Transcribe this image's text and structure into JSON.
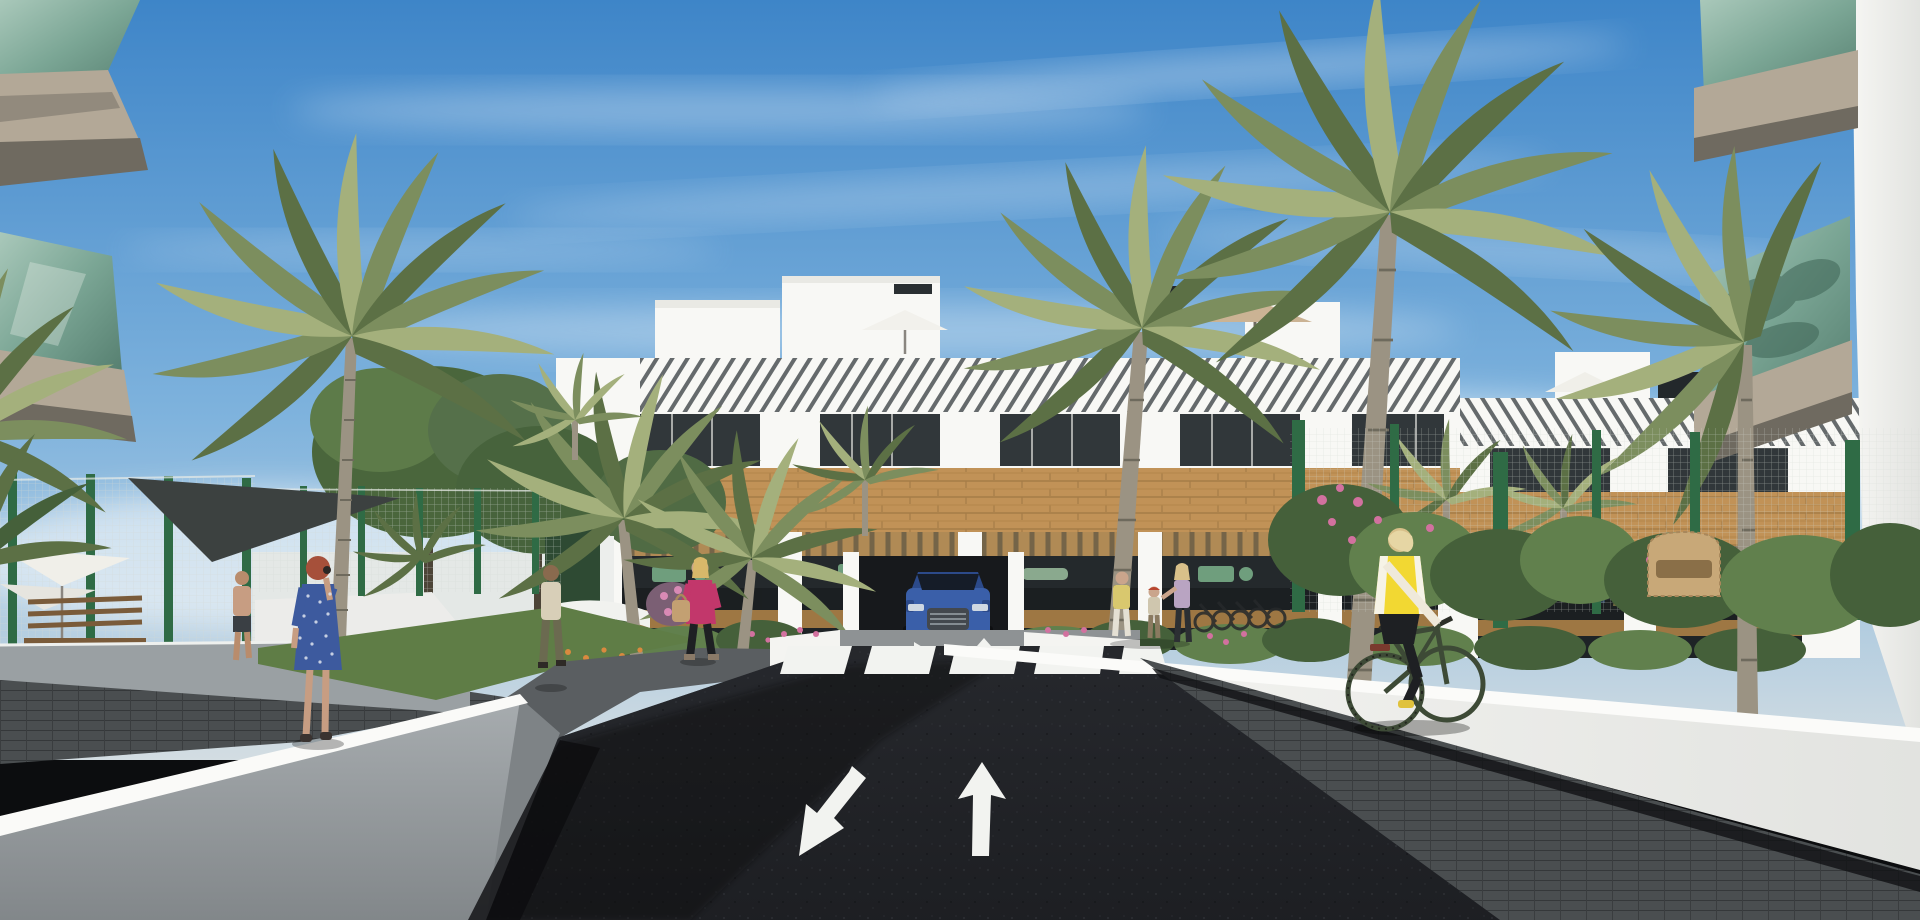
{
  "scene": {
    "type": "architectural 3D render",
    "setting": "Modern Mediterranean apartment complex: palm-lined entrance road leading to a white residential block",
    "time_of_day": "midday, clear blue sky with thin cirrus clouds",
    "camera": "street-level one-point perspective down the access road"
  },
  "colors": {
    "sky_top": "#3e85c8",
    "sky_mid": "#7fb3dd",
    "sky_low": "#d3dde2",
    "cloud": "#ffffff",
    "building_white": "#f8f8f5",
    "slat_dark": "#4b5154",
    "wood": "#c19257",
    "wood_dark": "#9e7743",
    "terrace_dark": "#24292c",
    "balcony_glass": "#8fb5a6",
    "balcony_glass_dark": "#5d8678",
    "fascia_taupe": "#a89c8a",
    "palm_green": "#7c8e5e",
    "palm_trunk": "#9b9383",
    "fence_green": "#2f6b45",
    "wall_gray": "#9aa0a3",
    "wall_white": "#f5f5f2",
    "road": "#202226",
    "paver": "#4a4e50",
    "grass": "#5f7d46",
    "flower_pink": "#d2719f",
    "flower_orange": "#d98a3f",
    "marking_white": "#f2f3f0",
    "car_blue": "#3a5fa9",
    "vest_yellow": "#f2d832",
    "dress_blue": "#3d5a9e",
    "jacket_pink": "#c2376b",
    "shade_sail": "#3c4140"
  },
  "road": {
    "surface": "dark asphalt",
    "markings": {
      "crosswalk_stripes": 5,
      "lane_arrows": [
        {
          "direction": "toward viewer (down-left)"
        },
        {
          "direction": "away from viewer (up)"
        }
      ],
      "small_ramp_arrows": 2
    },
    "flanked_by": "white rendered retaining walls"
  },
  "buildings": {
    "background_block": {
      "storeys": 3,
      "style": "white render with timber-clad band, louvred attic fascia, recessed terraces with wood pergolas and dark glazing",
      "roof": "terraces with parasols and chimney stacks"
    },
    "foreground_left": "balcony corner with green glass balustrade and taupe fascia",
    "foreground_right": "balcony corner with green glass balustrade and taupe fascia"
  },
  "vehicles": [
    {
      "type": "SUV",
      "color_name": "blue",
      "location": "parked at garage ramp facing the road"
    }
  ],
  "people": [
    {
      "id": "woman-blue-dress",
      "description": "red-haired woman in blue polka-dot dress talking on a phone, seen from behind",
      "location": "left walkway"
    },
    {
      "id": "man-beige",
      "description": "man in beige shirt and olive trousers walking away",
      "location": "left path"
    },
    {
      "id": "woman-pink",
      "description": "blonde woman in magenta jacket with tan handbag",
      "location": "left path, walking left"
    },
    {
      "id": "man-shirtless",
      "description": "shirtless man in dark shorts",
      "location": "far-left garden"
    },
    {
      "id": "residents-group",
      "description": "two women and a child near the building forecourt",
      "location": "right forecourt"
    },
    {
      "id": "cyclist",
      "description": "blonde woman in yellow hi-vis vest, black leggings, dark green bicycle",
      "location": "right sidewalk"
    },
    {
      "id": "terrace-residents",
      "description": "small figures on first-floor terraces",
      "location": "background building"
    }
  ],
  "vegetation": {
    "palm_trees": {
      "count_estimate": 12,
      "types": [
        "date palm",
        "fan palm"
      ]
    },
    "shrubs": [
      "green hedges",
      "pink flowering shrubs",
      "orange flowers"
    ],
    "lawn": "left garden strip"
  },
  "fences": {
    "type": "wire-mesh security panels",
    "post_color": "green"
  },
  "furniture": [
    "white parasols",
    "wooden bench",
    "wicker armchair",
    "terrace dining sets",
    "sun loungers"
  ]
}
